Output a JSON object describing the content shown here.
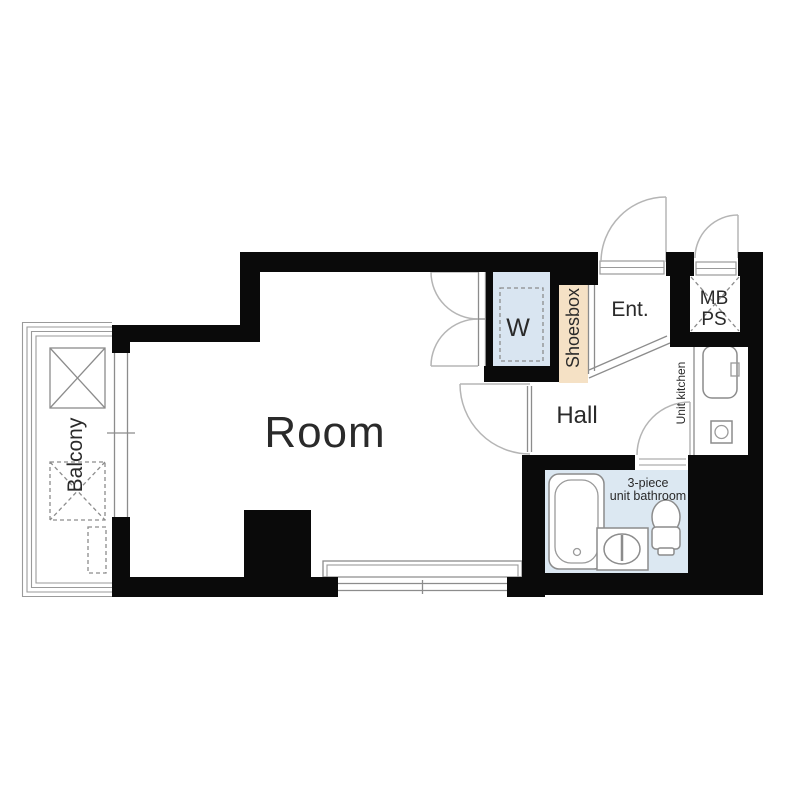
{
  "plan": {
    "room": "Room",
    "hall": "Hall",
    "entrance": "Ent.",
    "closet": "W",
    "shoesbox": "Shoesbox",
    "unit_kitchen": "Unit kitchen",
    "balcony": "Balcony",
    "meter_box": "MB",
    "pipe_shaft": "PS",
    "bathroom_line1": "3-piece",
    "bathroom_line2": "unit bathroom"
  },
  "colors": {
    "wall": "#0a0a0a",
    "closet_fill": "#d9e5f1",
    "shoesbox_fill": "#f5e1c5",
    "bathroom_fill": "#dce8f2",
    "text": "#2a2a2a",
    "background": "#ffffff"
  }
}
